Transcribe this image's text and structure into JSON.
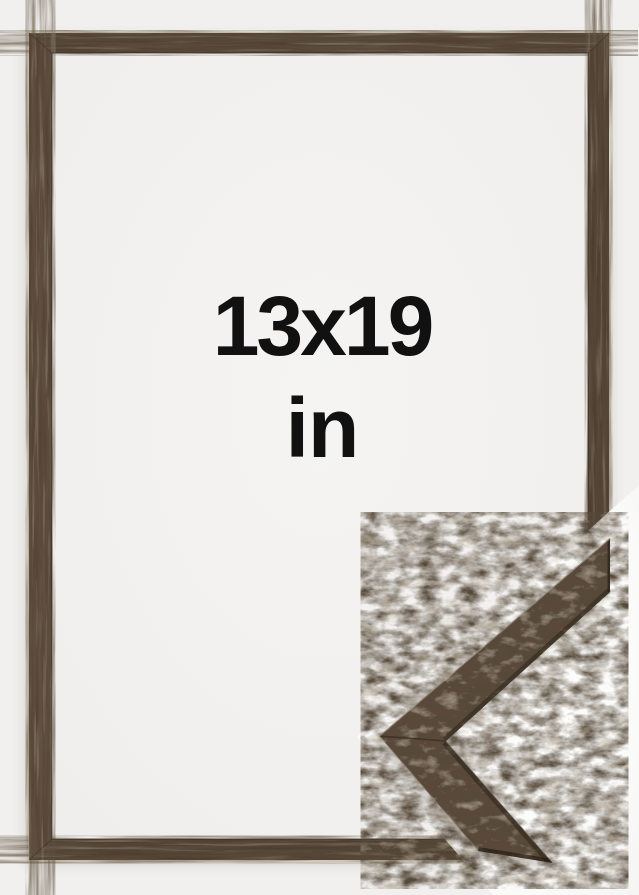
{
  "product_photo": {
    "size_label": "13x19",
    "unit_label": "in",
    "description": "Brown wooden picture frame shown empty with a close-up corner profile sample overlapping the lower-right corner"
  },
  "colors": {
    "page_background": "#f1f0ee",
    "frame_opening": "#f5f4f3",
    "detail_background": "#fdfdfc",
    "frame_wood_base": "#544334",
    "sample_wood_base": "#5a4a3a",
    "wood_dark_edge": "#2e241a",
    "outer_highlight": "#ddd4c3",
    "text_color": "#111111"
  }
}
